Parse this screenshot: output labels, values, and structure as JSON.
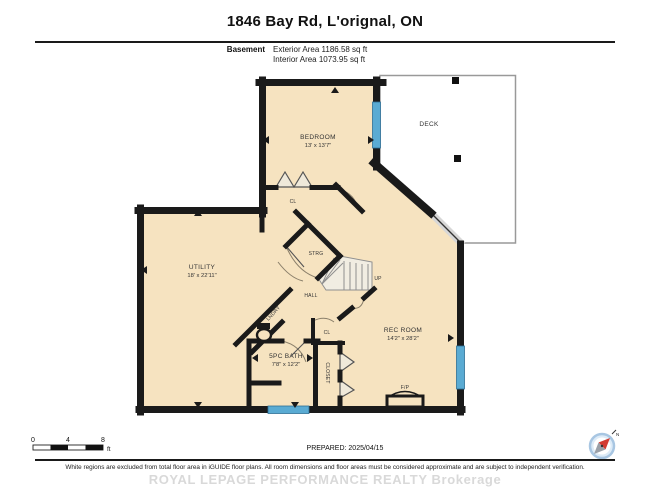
{
  "header": {
    "title": "1846 Bay Rd, L'orignal, ON",
    "floor_label": "Basement",
    "exterior_area": "Exterior Area 1186.58 sq ft",
    "interior_area": "Interior Area 1073.95 sq ft"
  },
  "plan": {
    "rooms": [
      {
        "name": "BEDROOM",
        "dims": "13' x 13'7\""
      },
      {
        "name": "CL",
        "dims": ""
      },
      {
        "name": "DECK",
        "dims": ""
      },
      {
        "name": "UTILITY",
        "dims": "18' x 22'11\""
      },
      {
        "name": "STRG",
        "dims": ""
      },
      {
        "name": "HALL",
        "dims": ""
      },
      {
        "name": "LNDRY",
        "dims": ""
      },
      {
        "name": "UP",
        "dims": ""
      },
      {
        "name": "CL",
        "dims": ""
      },
      {
        "name": "5PC BATH",
        "dims": "7'8\" x 12'2\""
      },
      {
        "name": "CLOSET",
        "dims": ""
      },
      {
        "name": "REC ROOM",
        "dims": "14'2\" x 28'2\""
      },
      {
        "name": "F/P",
        "dims": ""
      }
    ],
    "colors": {
      "floor": "#f6e3c0",
      "wall": "#1a1a1a",
      "window": "#5aabd3",
      "deck_outline": "#999999"
    }
  },
  "scale_bar": {
    "tick_0": "0",
    "tick_4": "4",
    "tick_8": "8",
    "unit": "ft"
  },
  "prepared": "PREPARED: 2025/04/15",
  "compass": {
    "label": "N"
  },
  "footer": {
    "disclaimer": "White regions are excluded from total floor area in iGUIDE floor plans. All room dimensions and floor areas must be considered approximate and are subject to independent verification.",
    "watermark": "ROYAL LEPAGE PERFORMANCE REALTY Brokerage"
  }
}
